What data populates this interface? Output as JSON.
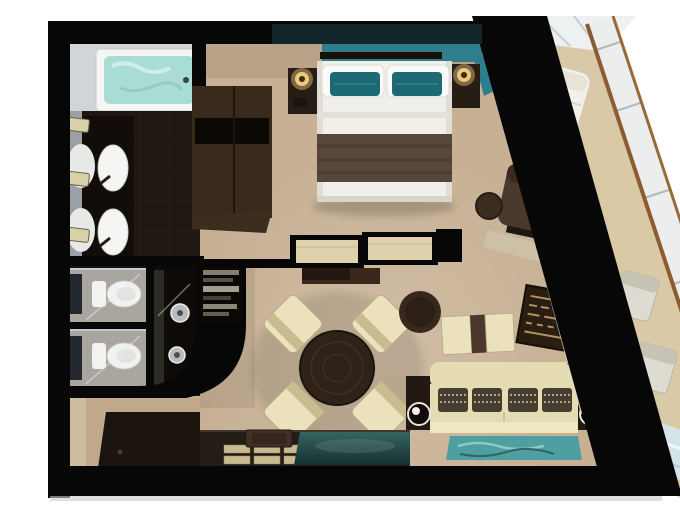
{
  "meta": {
    "description": "Top-down 3D rendered floor plan of a cruise-ship suite: bathroom with tub and double sinks, two toilet compartments with shower, bedroom with double bed, living room with dining set and sofa, dark bar counter, and an angled private balcony with lounger and chairs behind a glass hull railing",
    "image_type": "photorealistic floor plan render"
  },
  "palette": {
    "bg": "#ffffff",
    "wall": "#070707",
    "carpet": "#c7b093",
    "bathWall": "#d2d5d7",
    "water": "#a9dcd4",
    "tile": "#1f1812",
    "woodD": "#271c12",
    "woodM": "#3a2a1c",
    "woodL": "#4a372a",
    "cream": "#ebe2bd",
    "sofaCream": "#e6dcb4",
    "pillowDark": "#453e2e",
    "tealWall": "#2f7e8e",
    "tealPillow": "#1e6a74",
    "tealRug": "#4e9fa0",
    "tealGlass": "#2a5654",
    "balconyFloor": "#d9c9a6",
    "glassLight": "#eceeed",
    "toiletWhite": "#f2f3f1",
    "counterDark": "#241d16",
    "matDark": "#1b140e",
    "lampGlow": "#eac87e",
    "hullWood": "#8a5c30",
    "topWallTeal": "#13262c"
  },
  "rooms": {
    "bathroom": {
      "label": "Bathroom",
      "features": [
        "bathtub with water",
        "double-sink vanity",
        "mirror wall",
        "towels",
        "dark tile floor"
      ]
    },
    "water_closets": {
      "label": "Toilet compartments",
      "features": [
        "toilet 1",
        "toilet 2",
        "glass partitions",
        "shower with two heads"
      ]
    },
    "bedroom": {
      "label": "Bedroom",
      "features": [
        "double bed",
        "teal accent pillows",
        "brown bed runner",
        "two nightstands with lamps",
        "teal headboard wall",
        "wardrobe",
        "reading chair with footstool",
        "desk with TV"
      ]
    },
    "living_room": {
      "label": "Living room",
      "features": [
        "round dining table with four chairs",
        "round ottoman",
        "two-seat bench",
        "patterned pouf",
        "sofa with four pillows",
        "end tables with speakers",
        "teal rug",
        "bar counter with tray and placemats",
        "teal glass top"
      ]
    },
    "balcony": {
      "label": "Private balcony",
      "features": [
        "sun lounger",
        "two chairs",
        "side table",
        "glass hull railing with wood trim",
        "glass floor section"
      ]
    },
    "entry": {
      "label": "Entry hall",
      "features": [
        "dark floor mat"
      ]
    }
  }
}
